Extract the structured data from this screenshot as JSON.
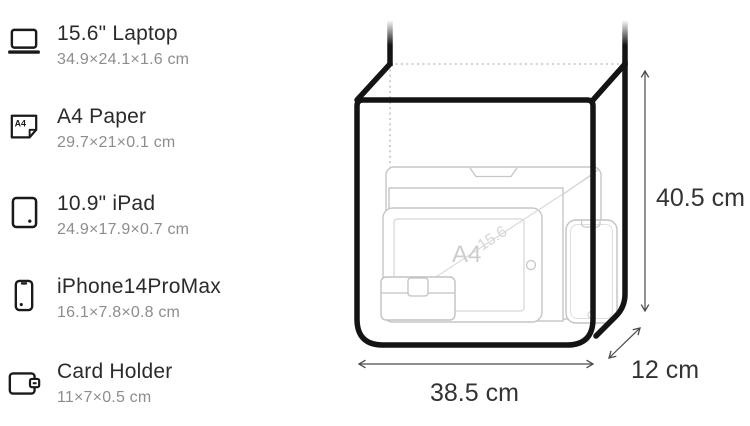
{
  "items": [
    {
      "icon": "laptop-icon",
      "title": "15.6\" Laptop",
      "dims": "34.9×24.1×1.6 cm"
    },
    {
      "icon": "a4-paper-icon",
      "title": "A4 Paper",
      "dims": "29.7×21×0.1 cm"
    },
    {
      "icon": "ipad-icon",
      "title": "10.9\" iPad",
      "dims": "24.9×17.9×0.7 cm"
    },
    {
      "icon": "iphone-icon",
      "title": "iPhone14ProMax",
      "dims": "16.1×7.8×0.8 cm"
    },
    {
      "icon": "card-holder-icon",
      "title": "Card Holder",
      "dims": "11×7×0.5 cm"
    }
  ],
  "diagram": {
    "height_label": "40.5 cm",
    "width_label": "38.5 cm",
    "depth_label": "12 cm",
    "a4_watermark": "A4",
    "diagonal_watermark": "15.6",
    "icon_a4_text": "A4"
  },
  "colors": {
    "text_primary": "#2b2b2b",
    "text_secondary": "#8d8d8d",
    "bag_outline": "#141414",
    "item_outline": "#c6c6c6",
    "dimension_line": "#4a4a4a"
  }
}
